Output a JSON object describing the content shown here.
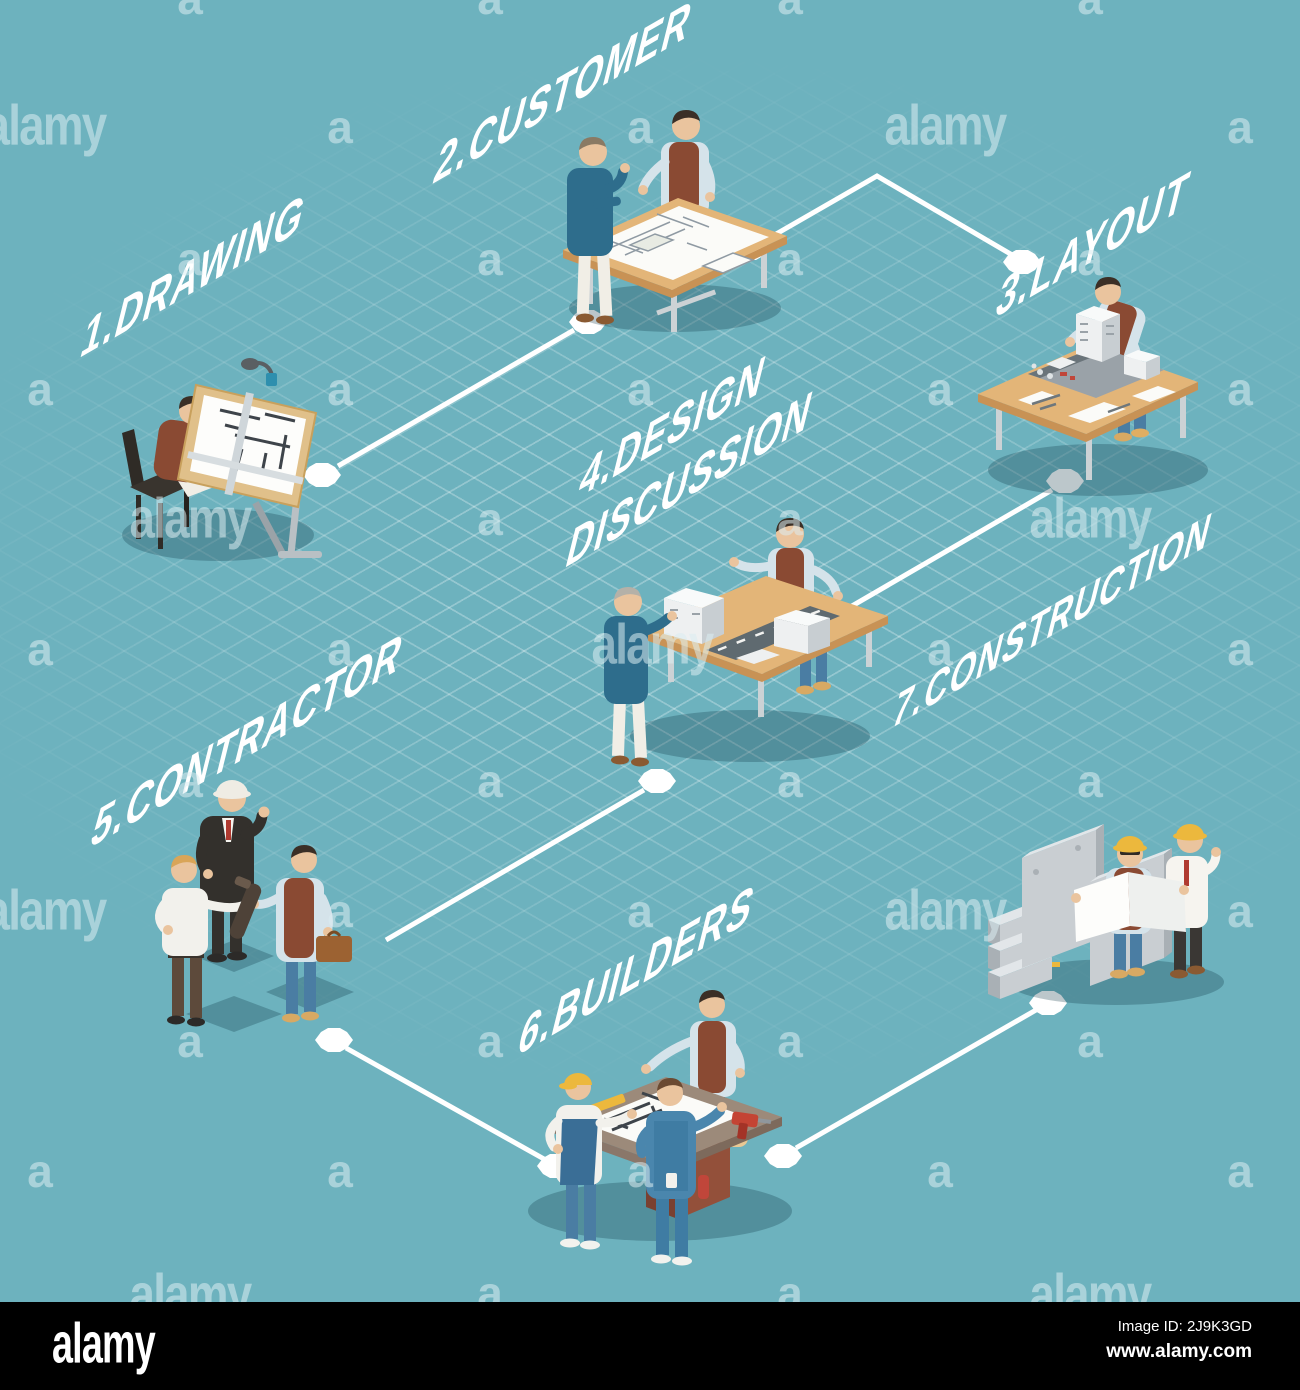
{
  "canvas": {
    "background": "#6db2be",
    "grid_color": "rgba(255,255,255,0.28)",
    "shadow_color": "rgba(13,54,68,0.28)"
  },
  "steps": [
    {
      "id": 1,
      "label": "1.DRAWING"
    },
    {
      "id": 2,
      "label": "2.CUSTOMER"
    },
    {
      "id": 3,
      "label": "3.LAYOUT"
    },
    {
      "id": 4,
      "label": "4.DESIGN",
      "label2": "DISCUSSION"
    },
    {
      "id": 5,
      "label": "5.CONTRACTOR"
    },
    {
      "id": 6,
      "label": "6.BUILDERS"
    },
    {
      "id": 7,
      "label": "7.CONSTRUCTION"
    }
  ],
  "flow": {
    "line_color": "#ffffff",
    "node_color": "#ffffff",
    "nodes": [
      {
        "x": 322,
        "y": 475
      },
      {
        "x": 588,
        "y": 322
      },
      {
        "x": 750,
        "y": 248
      },
      {
        "x": 1022,
        "y": 262
      },
      {
        "x": 1065,
        "y": 481
      },
      {
        "x": 800,
        "y": 636
      },
      {
        "x": 657,
        "y": 781
      },
      {
        "x": 334,
        "y": 1040
      },
      {
        "x": 556,
        "y": 1166
      },
      {
        "x": 783,
        "y": 1156
      },
      {
        "x": 1048,
        "y": 1003
      }
    ],
    "lines": [
      {
        "points": [
          [
            338,
            466
          ],
          [
            574,
            330
          ]
        ]
      },
      {
        "points": [
          [
            764,
            241
          ],
          [
            877,
            176
          ],
          [
            1014,
            256
          ]
        ]
      },
      {
        "points": [
          [
            1052,
            490
          ],
          [
            814,
            628
          ]
        ]
      },
      {
        "points": [
          [
            644,
            790
          ],
          [
            386,
            940
          ]
        ]
      },
      {
        "points": [
          [
            346,
            1048
          ],
          [
            544,
            1159
          ]
        ]
      },
      {
        "points": [
          [
            796,
            1148
          ],
          [
            1036,
            1010
          ]
        ]
      }
    ]
  },
  "watermarks": {
    "symbol": "a",
    "logo": "alamy",
    "a_positions": [
      [
        190,
        -2
      ],
      [
        490,
        -2
      ],
      [
        790,
        -2
      ],
      [
        1090,
        -2
      ],
      [
        340,
        127
      ],
      [
        640,
        127
      ],
      [
        1240,
        127
      ],
      [
        190,
        259
      ],
      [
        490,
        259
      ],
      [
        790,
        259
      ],
      [
        1090,
        259
      ],
      [
        40,
        389
      ],
      [
        340,
        389
      ],
      [
        640,
        389
      ],
      [
        940,
        389
      ],
      [
        1240,
        389
      ],
      [
        490,
        519
      ],
      [
        790,
        519
      ],
      [
        40,
        649
      ],
      [
        340,
        649
      ],
      [
        940,
        649
      ],
      [
        1240,
        649
      ],
      [
        190,
        781
      ],
      [
        490,
        781
      ],
      [
        790,
        781
      ],
      [
        1090,
        781
      ],
      [
        340,
        911
      ],
      [
        640,
        911
      ],
      [
        1240,
        911
      ],
      [
        190,
        1041
      ],
      [
        490,
        1041
      ],
      [
        790,
        1041
      ],
      [
        1090,
        1041
      ],
      [
        40,
        1171
      ],
      [
        340,
        1171
      ],
      [
        640,
        1171
      ],
      [
        940,
        1171
      ],
      [
        1240,
        1171
      ],
      [
        490,
        1293
      ],
      [
        790,
        1293
      ]
    ],
    "logo_positions": [
      [
        45,
        126
      ],
      [
        945,
        126
      ],
      [
        190,
        519
      ],
      [
        1090,
        519
      ],
      [
        652,
        645
      ],
      [
        45,
        911
      ],
      [
        945,
        911
      ],
      [
        190,
        1295
      ],
      [
        1090,
        1295
      ]
    ]
  },
  "footer": {
    "logo": "alamy",
    "image_id": "Image ID: 2J9K3GD",
    "website": "www.alamy.com"
  }
}
